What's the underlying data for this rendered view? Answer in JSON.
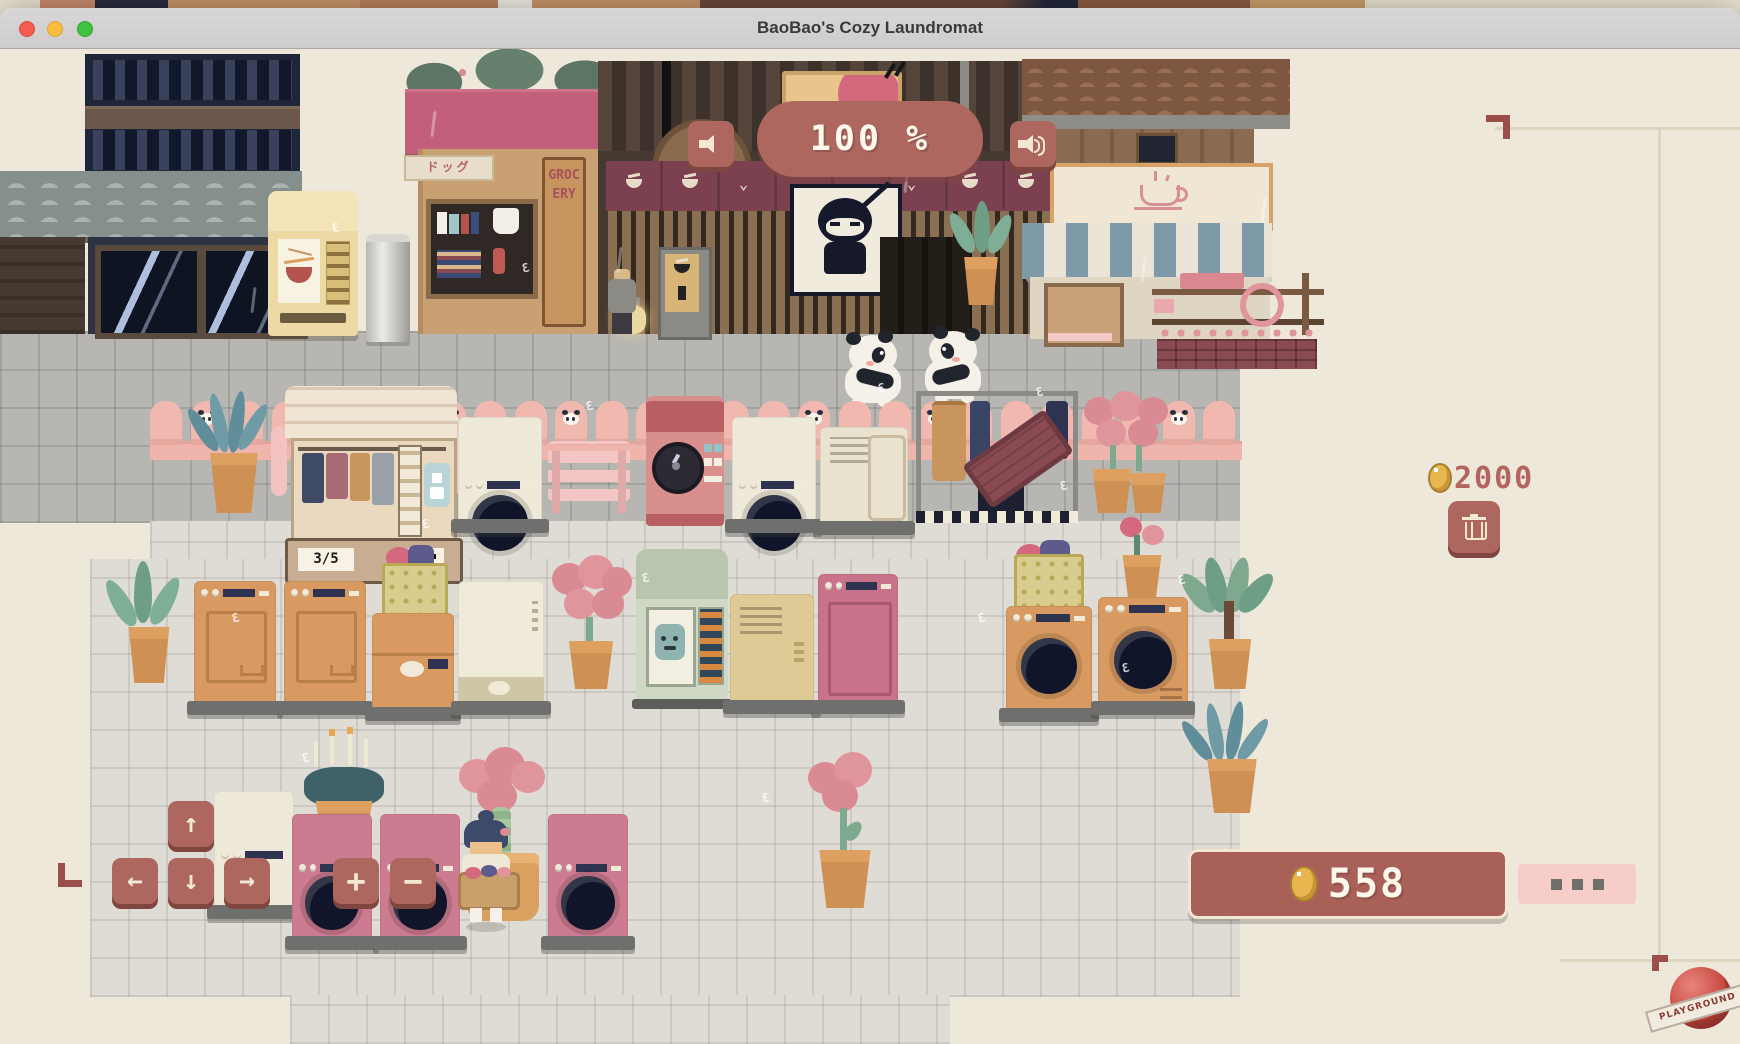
{
  "window": {
    "title": "BaoBao's Cozy Laundromat",
    "traffic_lights": [
      "close",
      "minimize",
      "zoom"
    ]
  },
  "hud": {
    "volume_percent": "100 %",
    "volume_down_icon": "speaker-icon",
    "volume_up_icon": "speaker-waves-icon",
    "coins_top": "2000",
    "coins_bottom": "558",
    "coin_icon": "coin-icon",
    "trash_icon": "trash-icon",
    "more_icon": "ellipsis-icon",
    "dpad": {
      "up": "↑",
      "down": "↓",
      "left": "←",
      "right": "→"
    },
    "stepper": {
      "plus": "+",
      "minus": "−"
    }
  },
  "scene": {
    "grocery_sign": "GROCERY",
    "katakana_sign": "ドッグ",
    "rack_count_badge": "3/5",
    "logo_ribbon": "PLAYGROUND"
  },
  "colors": {
    "accent_rose": "#ad675f",
    "accent_rose_dark": "#7e463f",
    "fence_pink": "#f0b8af",
    "coin_gold": "#e7b64f",
    "money_pill": "#a86058",
    "pink_button": "#f6cdc9",
    "bg_beige": "#eee8db",
    "walk_gray": "#b7b6b2",
    "tile_light": "#dedcd4"
  }
}
